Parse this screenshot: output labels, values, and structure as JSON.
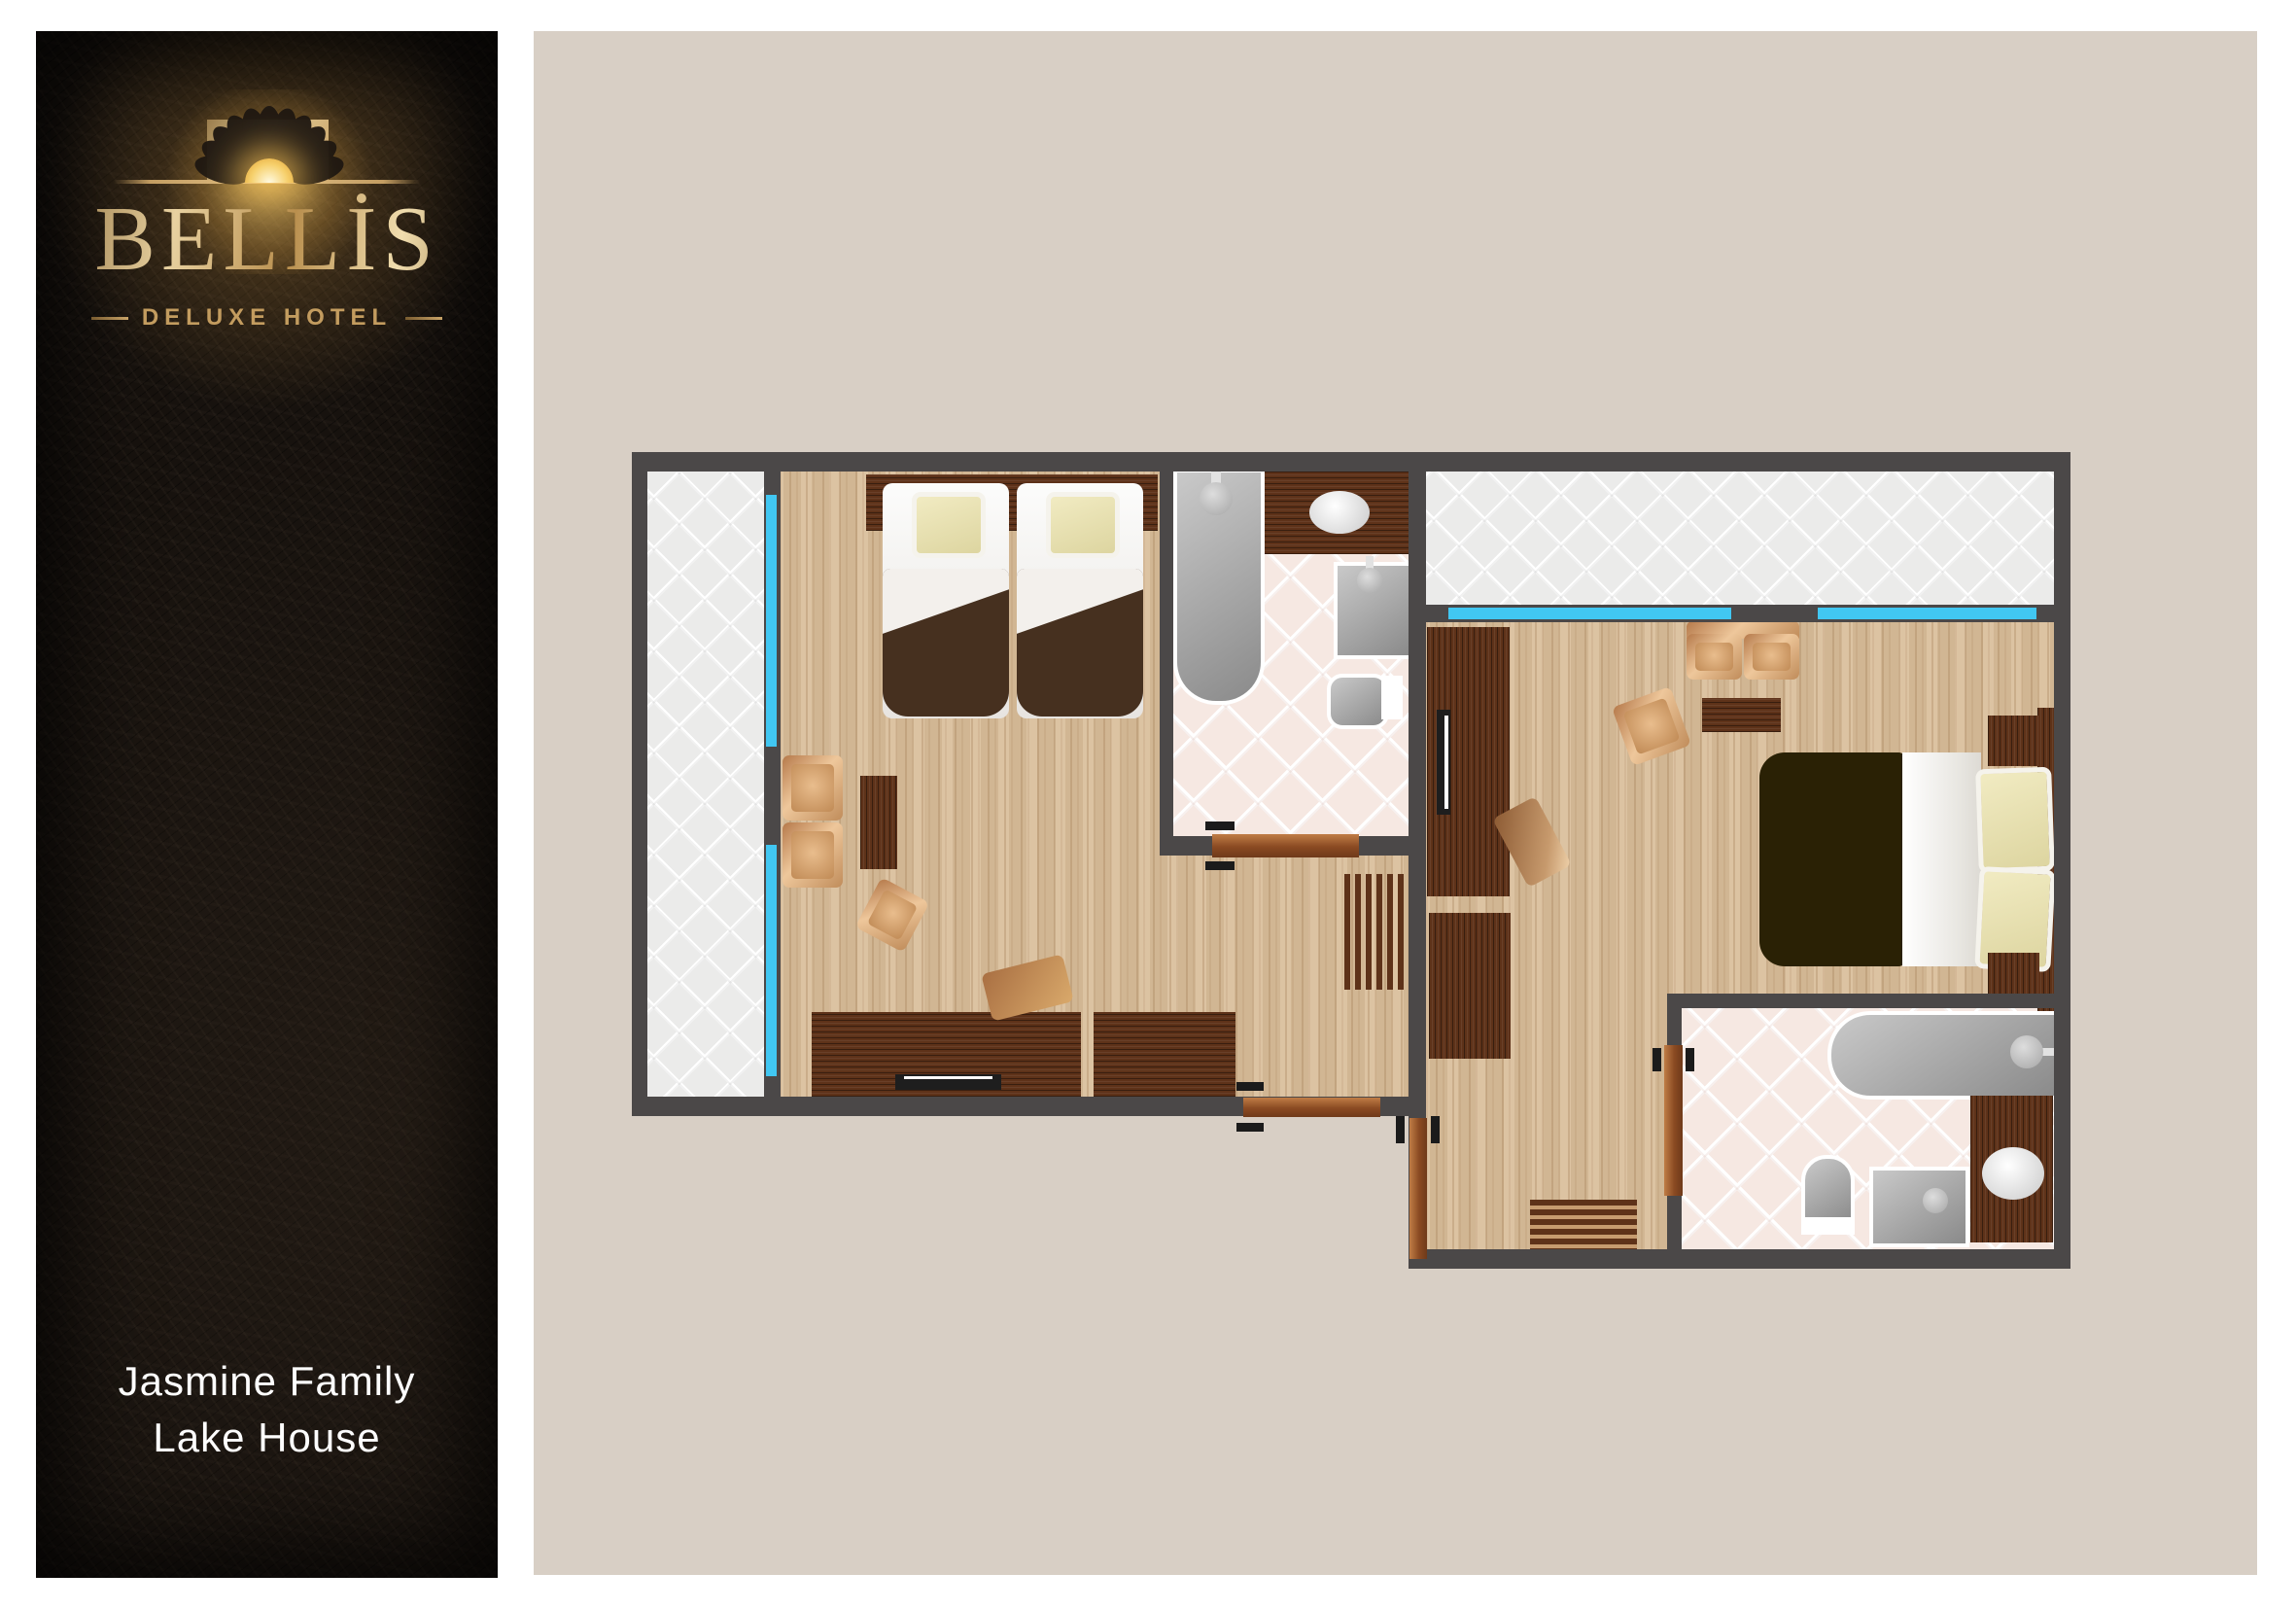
{
  "sidebar": {
    "brand": "BELLİS",
    "tagline": "DELUXE HOTEL",
    "room_name_line1": "Jasmine Family",
    "room_name_line2": "Lake House"
  },
  "colors": {
    "leather_background": "#17120e",
    "gold_accent": "#c9a468",
    "panel_background": "#d8cfc5",
    "wall": "#4b4848",
    "window_accent": "#41c7f2",
    "wood_floor": "#d8bc98",
    "dark_wood_furniture": "#5e3219",
    "bathroom_tile": "#f6e8e2",
    "terrace_quilt": "#ebebea",
    "twin_bed_duvet": "#46301f",
    "double_bed_duvet": "#2a2105",
    "pillow_cream": "#ece5b8",
    "room_name_text": "#fdfdfd"
  },
  "icons": [
    "daisy-sun-logo-icon"
  ]
}
